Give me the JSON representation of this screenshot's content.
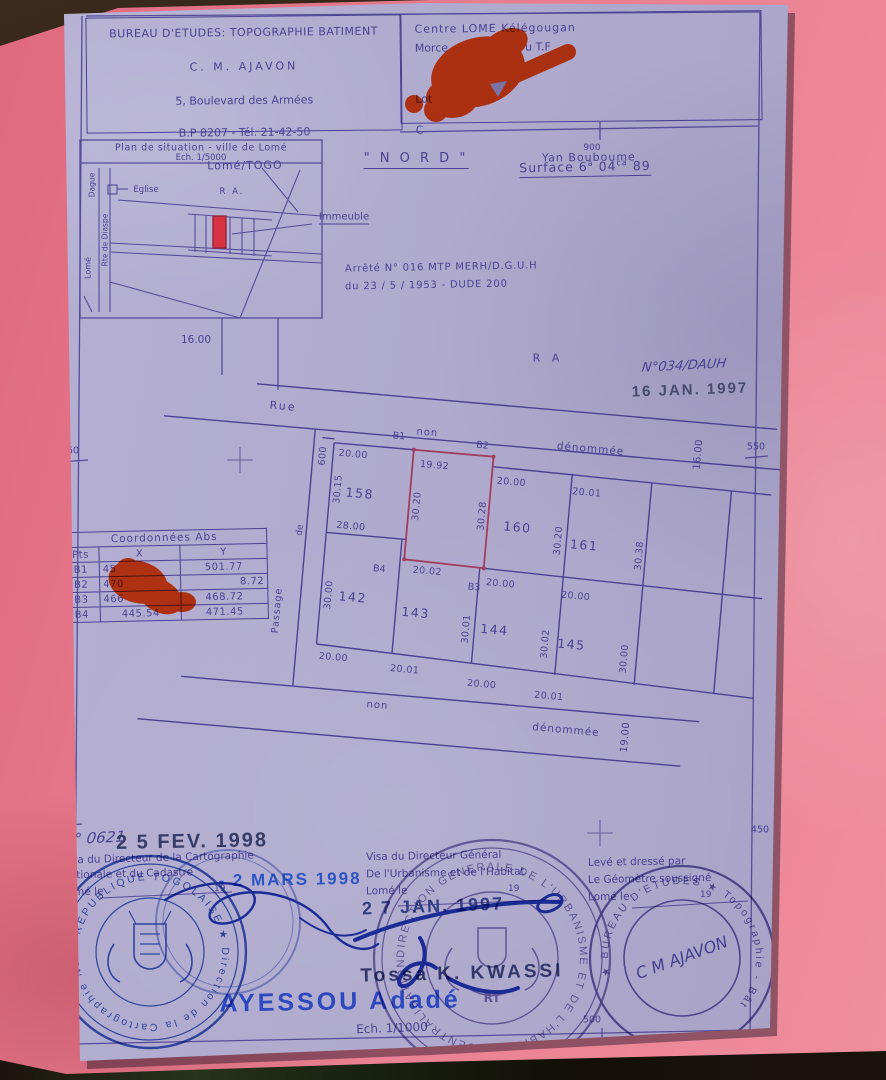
{
  "doc": {
    "header_left": {
      "line1": "BUREAU D'ETUDES: TOPOGRAPHIE BATIMENT",
      "line2": "C. M. AJAVON",
      "line3": "5, Boulevard des Armées",
      "line4": "B.P 8207 - Tél. 21-42-50",
      "line5": "Lomé/TOGO"
    },
    "header_right": {
      "line1": "Centre LOME  Kélégougan",
      "line2_start": "Morce",
      "line2_end": "u T.F",
      "line3": "Lot",
      "line4": "C",
      "line5": "Yan Bouboume"
    },
    "situation": {
      "title": "Plan de situation - ville de Lomé",
      "scale": "Ech. 1/5000",
      "church": "Eglise",
      "district": "R  A.",
      "street_left": "Dague",
      "street_left2": "Rte de Diaspe",
      "city": "Lomé",
      "building_label": "Immeuble"
    },
    "north": "\" N O R D \"",
    "surface": {
      "label": "Surface 6",
      "sup1": "a",
      "mid": " 04",
      "sup2": "ca",
      "end": " 89"
    },
    "arrete": {
      "line1": "Arrêté N° 016 MTP MERH/D.G.U.H",
      "line2": "du 23 / 5 / 1953 - DUDE 200"
    },
    "received": {
      "handwritten": "N°034/DAUH",
      "stamp": "16 JAN. 1997"
    },
    "grid": {
      "top": "900",
      "left_mid": "550",
      "right_mid": "550",
      "left_bottom": "450",
      "right_bottom": "450",
      "bottom": "500"
    },
    "road_width": "16.00",
    "area_label": "R A",
    "plan": {
      "street_top": {
        "name": "Rue",
        "word1": "non",
        "word2": "dénommée"
      },
      "street_bottom": {
        "word1": "non",
        "word2": "dénommée",
        "width": "19.00"
      },
      "passage": {
        "word1": "Passage",
        "word2": "de"
      },
      "block_tick": "600",
      "block_right_dim": "16.00",
      "points": {
        "b1": "B1",
        "b2": "B2",
        "b3": "B3",
        "b4": "B4"
      },
      "lots_top": [
        {
          "num": "158",
          "top": "20.00",
          "left": "30.15",
          "bottom": "28.00"
        },
        {
          "top": "19.92",
          "left": "30.20",
          "right": "30.28",
          "bottom": "20.02"
        },
        {
          "num": "160",
          "top": "20.00",
          "right": "30.20"
        },
        {
          "num": "161",
          "top": "20.01",
          "right": "30.38"
        }
      ],
      "lots_bottom": [
        {
          "num": "142",
          "left": "30.00",
          "bottom": "20.00"
        },
        {
          "num": "143",
          "right": "30.01",
          "bottom": "20.01"
        },
        {
          "num": "144",
          "top": "20.00",
          "right": "30.02",
          "bottom": "20.00"
        },
        {
          "num": "145",
          "top": "20.00",
          "right": "30.00",
          "bottom": "20.01"
        }
      ]
    },
    "coords_table": {
      "title": "Coordonnées  Abs",
      "col_pts": "Pts",
      "col_x": "X",
      "col_y": "Y",
      "rows": [
        {
          "pt": "B1",
          "x": "45",
          "y": "501.77"
        },
        {
          "pt": "B2",
          "x": "470",
          "y": "8.72"
        },
        {
          "pt": "B3",
          "x": "466",
          "y": "468.72"
        },
        {
          "pt": "B4",
          "x": "445.54",
          "y": "471.45"
        }
      ]
    },
    "visa_carto": {
      "ref": "N° 0621",
      "date_stamp": "2 5 FEV. 1998",
      "line1": "Visa du Directeur de la Cartographie",
      "line2": "Nationale et du Cadastre",
      "line3": "Lomé le",
      "year": "19",
      "blue_date": "- 2 MARS 1998"
    },
    "visa_urbanisme": {
      "line1": "Visa du Directeur Général",
      "line2": "De l'Urbanisme et de l'Habitat",
      "line3": "Lomé le",
      "year": "19",
      "date_stamp": "2 7 JAN. 1997",
      "signatory": "Tossa  K.  KWASSI"
    },
    "geometre": {
      "line1": "Levé et dressé par",
      "line2": "Le Géomètre soussigné",
      "line3": "Lomé le",
      "year": "19"
    },
    "approved_by": "AYESSOU  Adadé",
    "plan_scale": "Ech. 1/1000",
    "stamps": {
      "carto_ring": "★ REPUBLIQUE TOGOLAISE ★ Direction de la Cartographie Nationale et du Cadastre",
      "urbanisme_emblem": "RT",
      "urbanisme_ring": "DIRECTION GENERALE DE L'URBANISME ET DE L'HABITAT ★ CENTRALISATION ★",
      "geometre_ring": "★ BUREAU D'ETUDES ★ Topographie - Bât",
      "geometre_sig": "C M AJAVON"
    }
  },
  "colors": {
    "ink": "#4b4192",
    "red_marker": "#f84716",
    "blue_ink": "#2b49bb",
    "stamp_blue": "#2f55c4",
    "stamp_dark": "#363c66",
    "paper": "#b2adcf",
    "folder": "#e5798c"
  }
}
